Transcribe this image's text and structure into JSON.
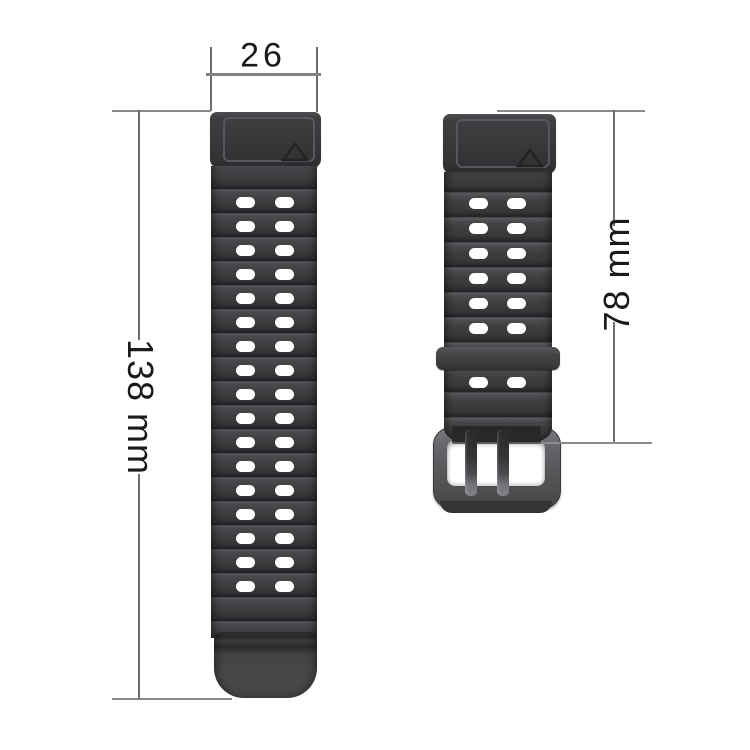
{
  "title": "watch-band-size-diagram",
  "background": "#ffffff",
  "annotations": {
    "band_width": {
      "label": "26"
    },
    "long_strap_length": {
      "label": "138 mm"
    },
    "short_strap_length": {
      "label": "78 mm"
    }
  },
  "style": {
    "dimension_line_color": "#8a8a8a",
    "annotation_text_color": "#1a1a1a",
    "strap_base_color": "#3e3e41",
    "strap_valley_color": "#202023",
    "strap_highlight_color": "#5a5a5e",
    "hole_color": "#ffffff",
    "buckle_color": "#5c5c5f",
    "triangle_mark_color": "#232326"
  },
  "long_strap": {
    "parts": [
      "connector",
      "wavy-band",
      "tip"
    ],
    "hole_rows": 17,
    "hole_columns": 2
  },
  "short_strap": {
    "parts": [
      "connector",
      "wavy-band",
      "keeper-loop",
      "buckle"
    ],
    "hole_rows_above_keeper": 6,
    "hole_rows_below_keeper": 1,
    "hole_columns": 2,
    "prongs": 2
  }
}
